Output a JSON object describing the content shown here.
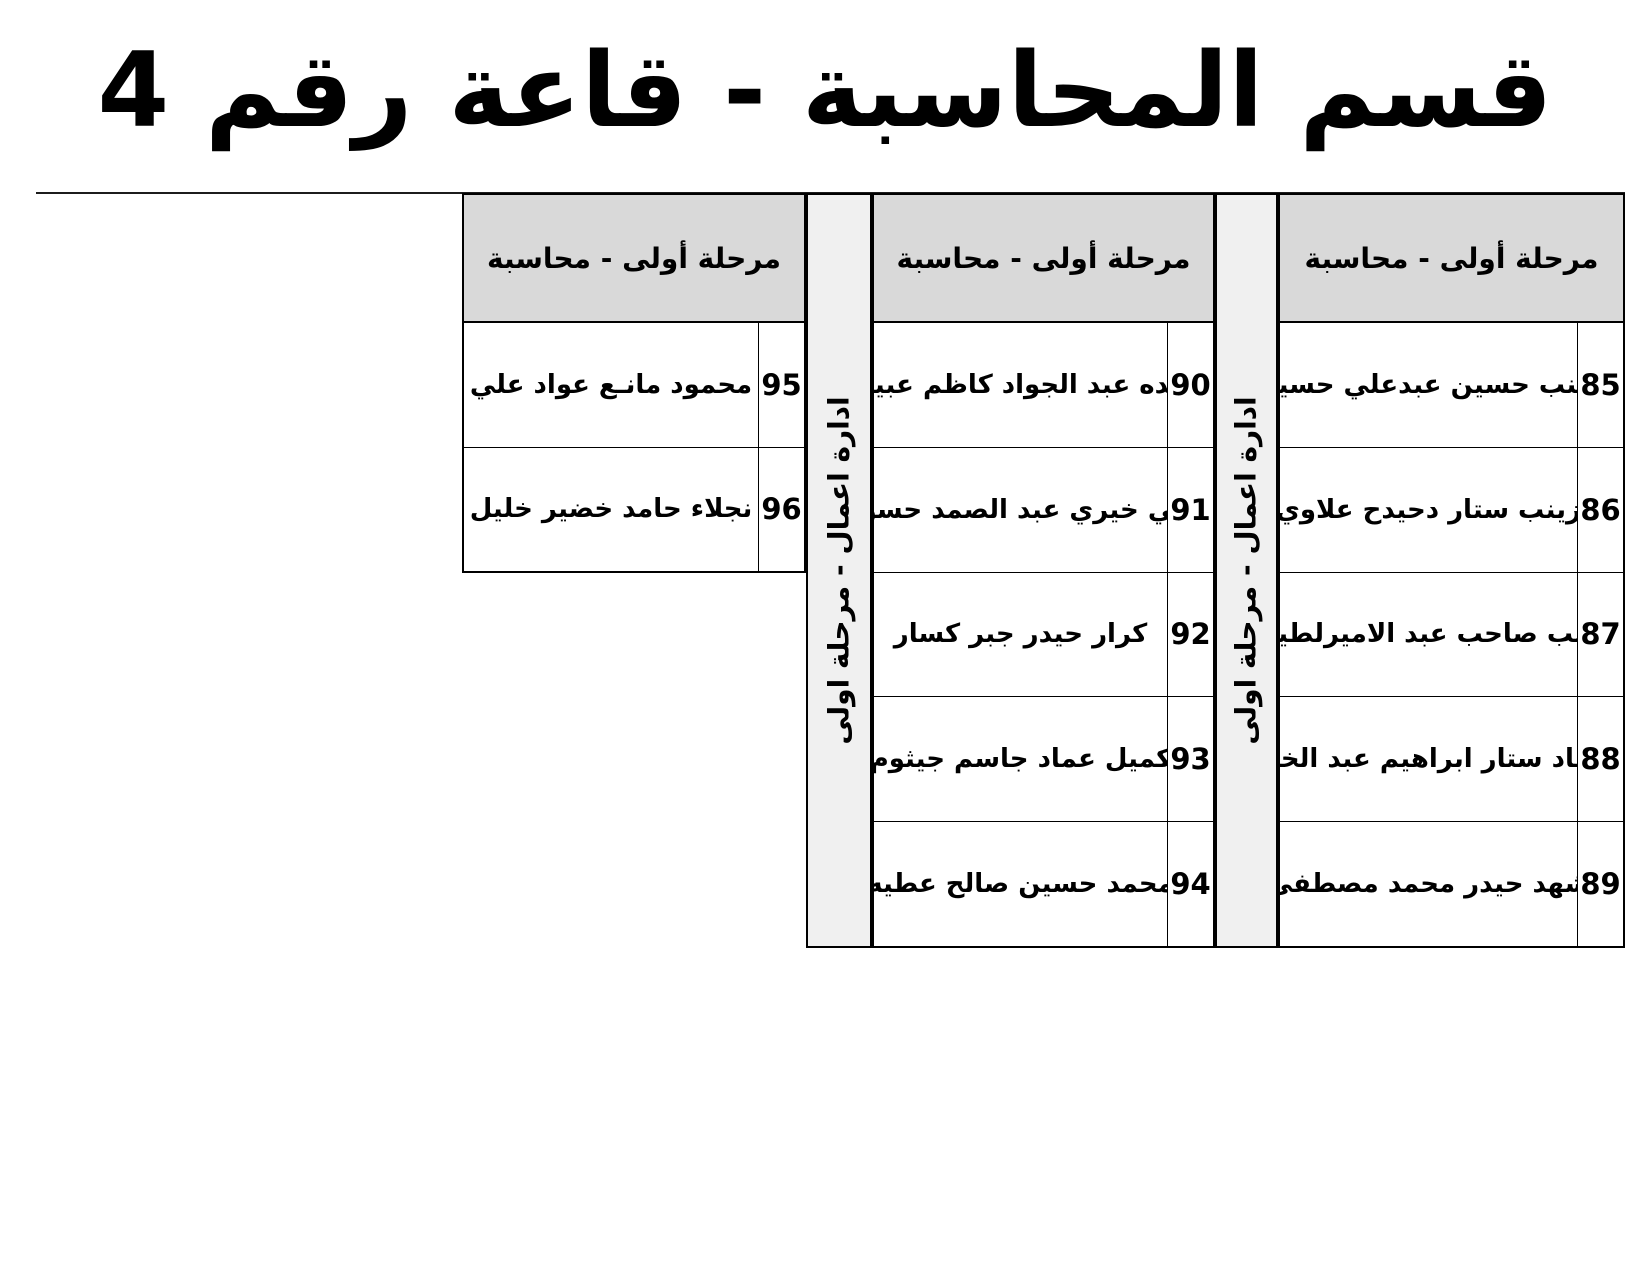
{
  "title": "قسم المحاسبة - قاعة رقم 4",
  "strips": [
    "ادارة اعمال - مرحلة اولى",
    "ادارة اعمال - مرحلة اولى"
  ],
  "groups": [
    {
      "position": "right",
      "header": "مرحلة أولى - محاسبة",
      "rows": [
        {
          "num": "85",
          "name": "زينب حسين عبدعلي حسين"
        },
        {
          "num": "86",
          "name": "زينب ستار دحيدح علاوي"
        },
        {
          "num": "87",
          "name": "زينب صاحب عبد الاميرلطيف"
        },
        {
          "num": "88",
          "name": "سجاد ستار ابراهيم عبد الخالق"
        },
        {
          "num": "89",
          "name": "شهد حيدر محمد مصطفى"
        }
      ]
    },
    {
      "position": "center",
      "header": "مرحلة أولى - محاسبة",
      "rows": [
        {
          "num": "90",
          "name": "عائده عبد الجواد كاظم عبيـان"
        },
        {
          "num": "91",
          "name": "علي خيري عبد الصمد حسون"
        },
        {
          "num": "92",
          "name": "كرار حيدر جبر كسار"
        },
        {
          "num": "93",
          "name": "كميل عماد جاسم جيثوم"
        },
        {
          "num": "94",
          "name": "محمد حسين صالح عطيه"
        }
      ]
    },
    {
      "position": "left",
      "header": "مرحلة أولى - محاسبة",
      "rows": [
        {
          "num": "95",
          "name": "محمود مانـع عواد علي"
        },
        {
          "num": "96",
          "name": "نجلاء حامد خضير خليل"
        }
      ]
    }
  ],
  "colors": {
    "page_bg": "#ffffff",
    "header_bg": "#d9d9d9",
    "strip_bg": "#f0f0f0",
    "border": "#000000",
    "text": "#000000"
  }
}
